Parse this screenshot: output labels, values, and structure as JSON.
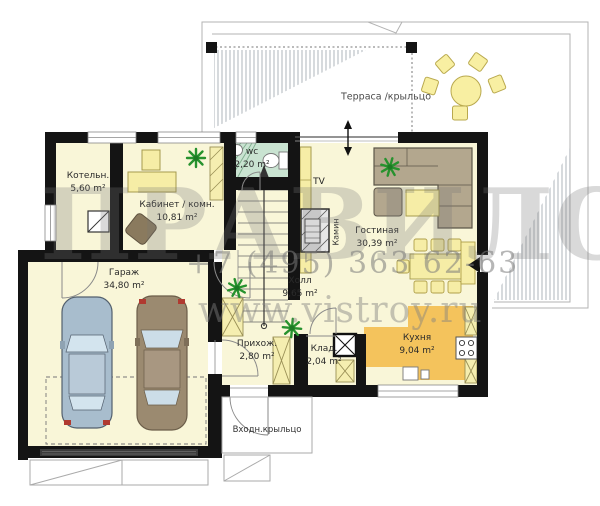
{
  "watermark": {
    "logo_text": "ПРАВИЛО",
    "phone": "+7 (495) 363 62-63",
    "website": "www.vistroy.ru"
  },
  "plan": {
    "terrace_label": "Терраса /крыльцо",
    "porch_label": "Входн.крыльцо",
    "tv_label": "TV",
    "fireplace_label": "Камин"
  },
  "rooms": [
    {
      "id": "boiler",
      "name": "Котельн.",
      "area": "5,60 m²"
    },
    {
      "id": "office",
      "name": "Кабинет / комн.",
      "area": "10,81 m²"
    },
    {
      "id": "wc",
      "name": "wc",
      "area": "2,20 m²"
    },
    {
      "id": "garage",
      "name": "Гараж",
      "area": "34,80 m²"
    },
    {
      "id": "hall",
      "name": "Холл",
      "area": "9,65 m²"
    },
    {
      "id": "entry",
      "name": "Прихож.",
      "area": "2,80 m²"
    },
    {
      "id": "storage",
      "name": "Клад.",
      "area": "2,04 m²"
    },
    {
      "id": "kitchen",
      "name": "Кухня",
      "area": "9,04 m²"
    },
    {
      "id": "living",
      "name": "Гостиная",
      "area": "30,39 m²"
    }
  ],
  "colors": {
    "wall": "#141414",
    "floor": "#f9f6d8",
    "wc_floor": "#c9e3d1",
    "kitchen_highlight": "#f4c35c",
    "furniture_yellow": "#f6eda6",
    "sofa_tan": "#b3a78e",
    "car_blue": "#a8bdcd",
    "car_brown": "#9b8a70",
    "plant_green": "#27922e",
    "watermark_gray": "#8a8a8a"
  }
}
